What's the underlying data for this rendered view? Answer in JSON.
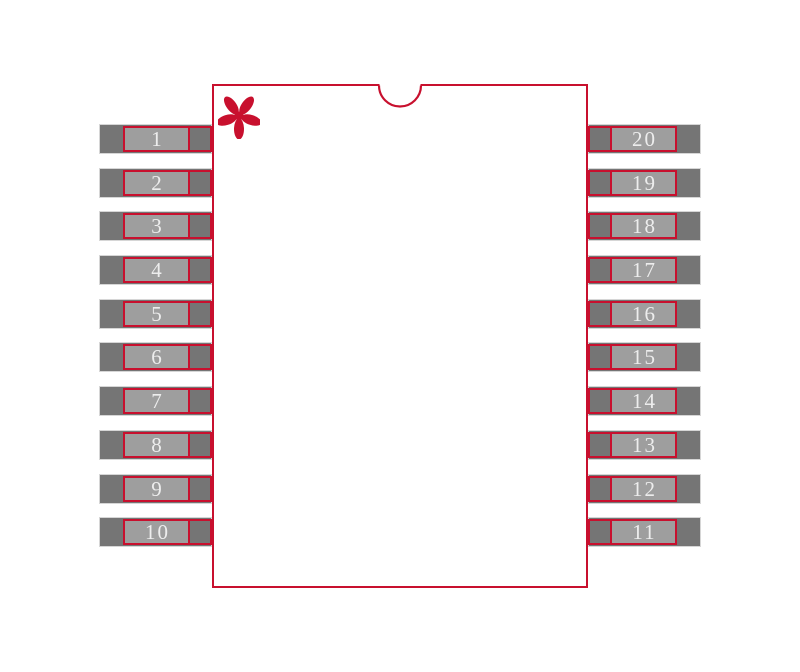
{
  "diagram": {
    "kind": "ic-package-footprint",
    "pin_count": 20
  },
  "pins": {
    "left": [
      "1",
      "2",
      "3",
      "4",
      "5",
      "6",
      "7",
      "8",
      "9",
      "10"
    ],
    "right": [
      "20",
      "19",
      "18",
      "17",
      "16",
      "15",
      "14",
      "13",
      "12",
      "11"
    ]
  },
  "markers": {
    "pin1_marker_glyph": "*"
  },
  "icons": {
    "pin1_marker": "asterisk-icon",
    "orientation_notch": "half-circle-notch-icon"
  },
  "colors": {
    "outline": "#c8102e",
    "pad_dark": "#757575",
    "pad_light": "#9e9e9e",
    "pad_edge": "#d6d6d6",
    "pin_text": "#ededed",
    "background": "#ffffff"
  }
}
